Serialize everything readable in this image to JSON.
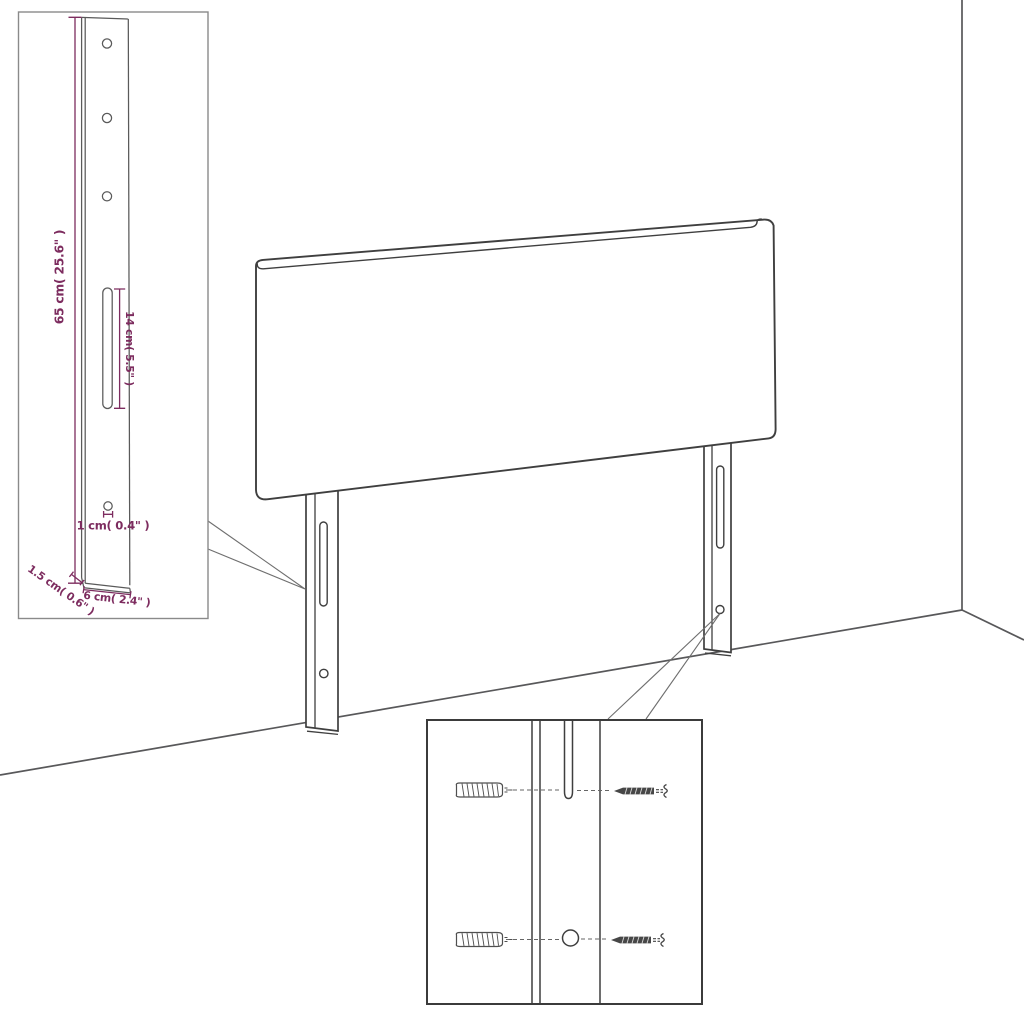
{
  "page": {
    "description": "Headboard with legs mounting-dimension diagram, wall corner scene",
    "background": "#ffffff"
  },
  "colors": {
    "outline": "#3f3f3f",
    "dimension_accent": "#7d2c5f",
    "inset_border": "#8a8a8a",
    "wall_line": "#58585a",
    "hardware": "#4a4a4a"
  },
  "dimension_inset": {
    "height_label": "65 cm( 25.6\" )",
    "slot_length_label": "14 cm( 5.5\" )",
    "hole_diameter_label": "1 cm( 0.4\" )",
    "thickness_label": "1.5 cm( 0.6\" )",
    "width_label": "6 cm( 2.4\" )"
  },
  "mounting_inset": {
    "wall_plugs_count": 2,
    "screws_count": 2
  }
}
